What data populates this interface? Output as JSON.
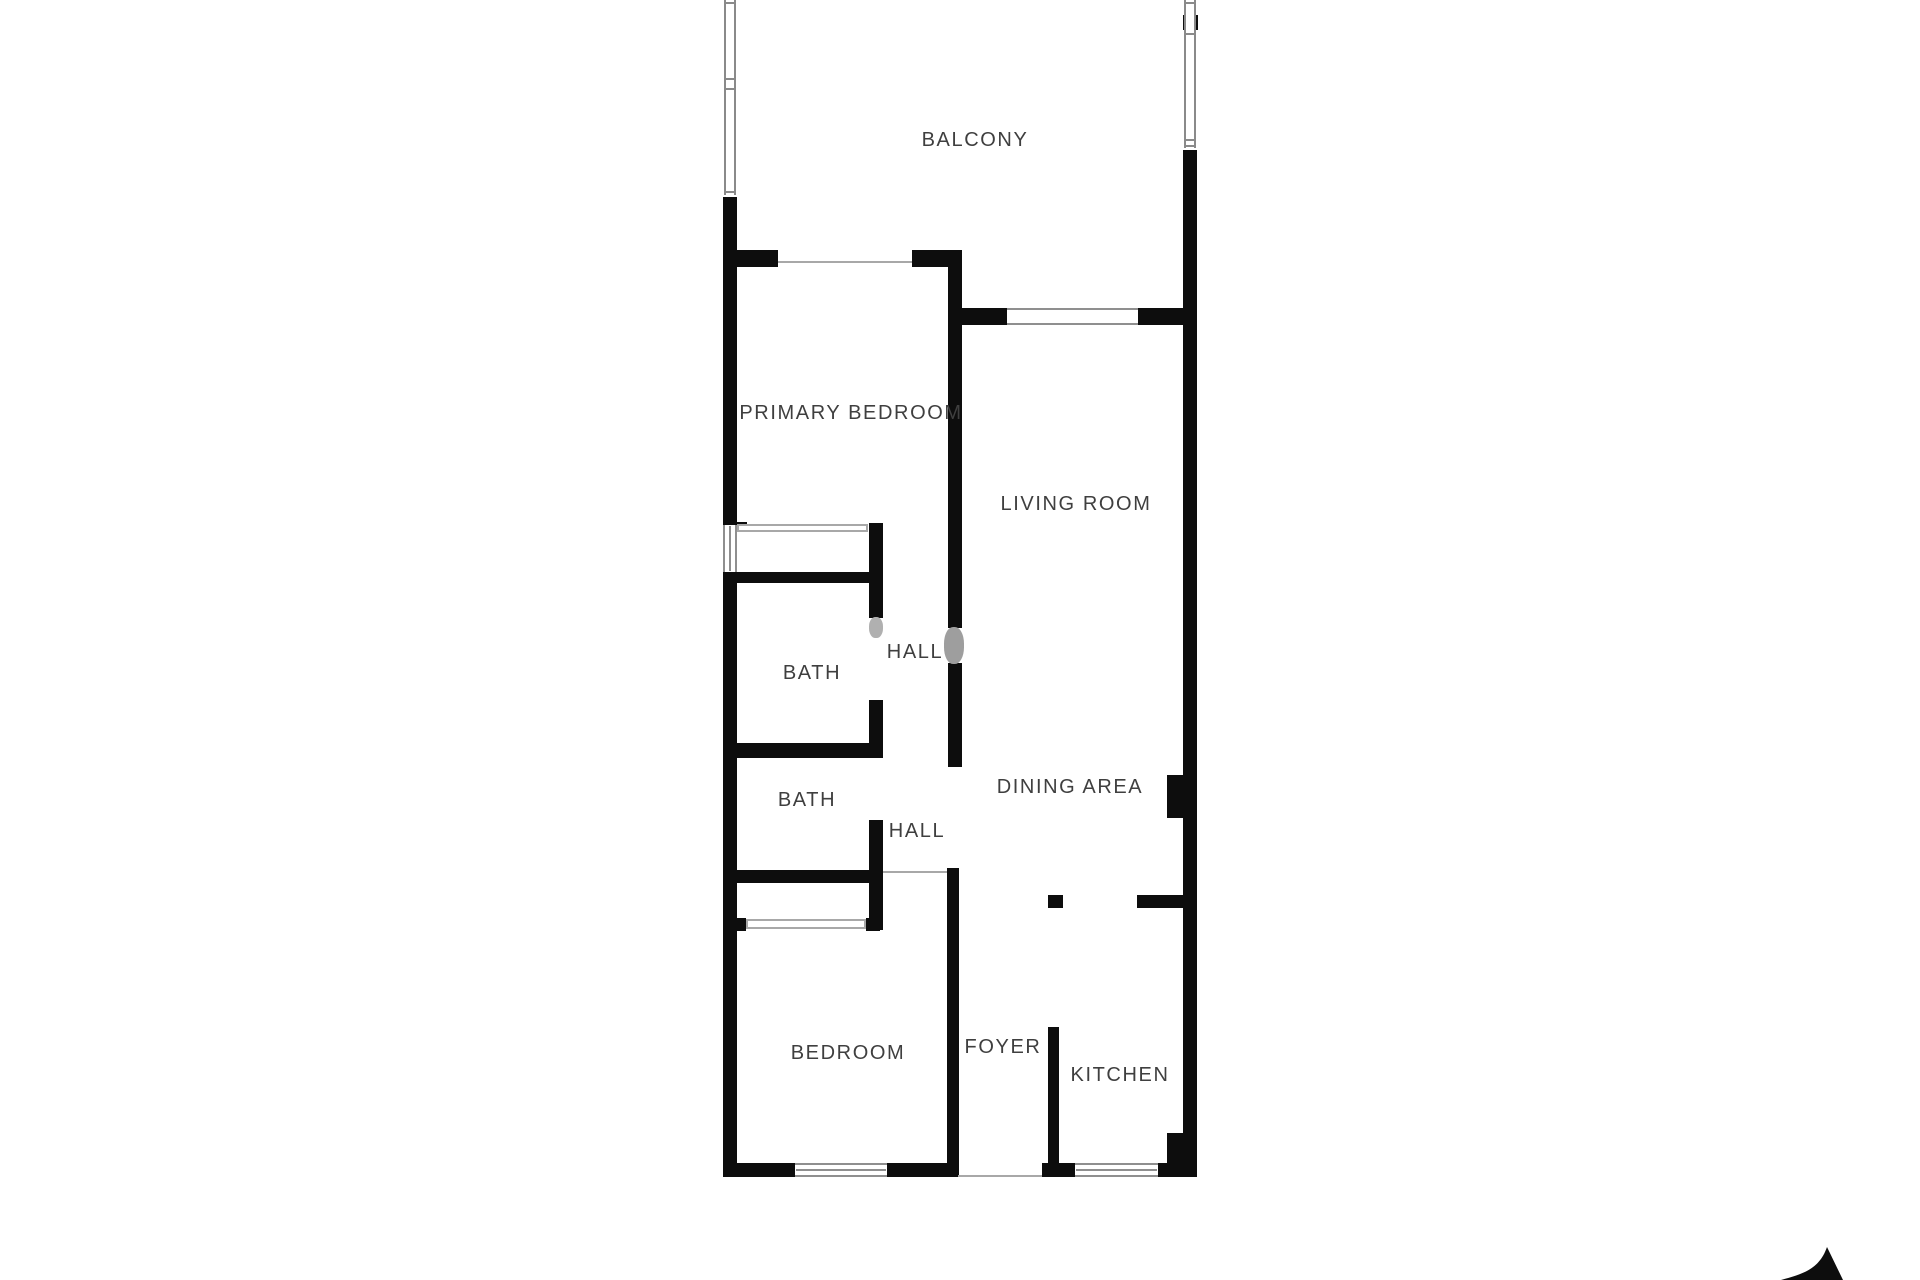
{
  "plan": {
    "colors": {
      "background": "#ffffff",
      "wall": "#0d0d0d",
      "thin_line": "#a8a8a8",
      "window_frame": "#8f8f8f",
      "label_text": "#3f3f3f",
      "watermark": "#9e9e9e"
    },
    "rooms": [
      {
        "id": "balcony",
        "label": "BALCONY",
        "x": 975,
        "y": 140
      },
      {
        "id": "primary-bedroom",
        "label": "PRIMARY BEDROOM",
        "x": 851,
        "y": 413
      },
      {
        "id": "living-room",
        "label": "LIVING ROOM",
        "x": 1076,
        "y": 504
      },
      {
        "id": "bath-1",
        "label": "BATH",
        "x": 812,
        "y": 673
      },
      {
        "id": "hall-1",
        "label": "HALL",
        "x": 915,
        "y": 652
      },
      {
        "id": "bath-2",
        "label": "BATH",
        "x": 807,
        "y": 800
      },
      {
        "id": "hall-2",
        "label": "HALL",
        "x": 917,
        "y": 831
      },
      {
        "id": "dining-area",
        "label": "DINING AREA",
        "x": 1070,
        "y": 787
      },
      {
        "id": "bedroom",
        "label": "BEDROOM",
        "x": 848,
        "y": 1053
      },
      {
        "id": "foyer",
        "label": "FOYER",
        "x": 1003,
        "y": 1047
      },
      {
        "id": "kitchen",
        "label": "KITCHEN",
        "x": 1120,
        "y": 1075
      }
    ],
    "walls": [
      {
        "name": "left-wall-upper",
        "x": 723,
        "y": 197,
        "w": 14,
        "h": 328
      },
      {
        "name": "left-wall-lower",
        "x": 723,
        "y": 572,
        "w": 14,
        "h": 605
      },
      {
        "name": "primary-bedroom-top-wall-left",
        "x": 723,
        "y": 250,
        "w": 55,
        "h": 17
      },
      {
        "name": "primary-bedroom-top-wall-right",
        "x": 912,
        "y": 250,
        "w": 50,
        "h": 17
      },
      {
        "name": "living-wall-upper",
        "x": 948,
        "y": 250,
        "w": 14,
        "h": 378
      },
      {
        "name": "living-wall-lower",
        "x": 948,
        "y": 663,
        "w": 14,
        "h": 104
      },
      {
        "name": "living-room-top-wall-left",
        "x": 948,
        "y": 308,
        "w": 59,
        "h": 17
      },
      {
        "name": "living-room-top-wall-right",
        "x": 1138,
        "y": 308,
        "w": 59,
        "h": 17
      },
      {
        "name": "right-wall-balcony-stub",
        "x": 1183,
        "y": 15,
        "w": 15,
        "h": 15
      },
      {
        "name": "right-wall",
        "x": 1183,
        "y": 150,
        "w": 14,
        "h": 1027
      },
      {
        "name": "dining-column",
        "x": 1167,
        "y": 775,
        "w": 16,
        "h": 43
      },
      {
        "name": "bath-top-wall",
        "x": 723,
        "y": 572,
        "w": 160,
        "h": 11
      },
      {
        "name": "bath-hall-wall-upper",
        "x": 869,
        "y": 523,
        "w": 14,
        "h": 95
      },
      {
        "name": "bath-hall-wall-mid",
        "x": 869,
        "y": 700,
        "w": 14,
        "h": 58
      },
      {
        "name": "bath-hall-wall-lower",
        "x": 869,
        "y": 820,
        "w": 14,
        "h": 110
      },
      {
        "name": "bath-divider-wall",
        "x": 723,
        "y": 743,
        "w": 160,
        "h": 15
      },
      {
        "name": "hall-bottom-wall",
        "x": 723,
        "y": 870,
        "w": 157,
        "h": 13
      },
      {
        "name": "closet-stub-top-left",
        "x": 735,
        "y": 522,
        "w": 12,
        "h": 10
      },
      {
        "name": "closet-stub-bottom-left",
        "x": 735,
        "y": 918,
        "w": 11,
        "h": 13
      },
      {
        "name": "closet-stub-bottom-right",
        "x": 866,
        "y": 918,
        "w": 14,
        "h": 13
      },
      {
        "name": "foyer-wall",
        "x": 947,
        "y": 868,
        "w": 12,
        "h": 309
      },
      {
        "name": "kitchen-left-wall",
        "x": 1048,
        "y": 1027,
        "w": 11,
        "h": 136
      },
      {
        "name": "kitchen-entry-column",
        "x": 1048,
        "y": 895,
        "w": 15,
        "h": 13
      },
      {
        "name": "kitchen-entry-stub",
        "x": 1137,
        "y": 895,
        "w": 46,
        "h": 13
      },
      {
        "name": "kitchen-corner-block",
        "x": 1167,
        "y": 1133,
        "w": 26,
        "h": 30
      },
      {
        "name": "bedroom-bottom-wall-left",
        "x": 723,
        "y": 1163,
        "w": 72,
        "h": 14
      },
      {
        "name": "bedroom-bottom-wall-right",
        "x": 887,
        "y": 1163,
        "w": 71,
        "h": 14
      },
      {
        "name": "kitchen-bottom-wall-left",
        "x": 1042,
        "y": 1163,
        "w": 33,
        "h": 14
      },
      {
        "name": "kitchen-bottom-wall-right",
        "x": 1158,
        "y": 1163,
        "w": 39,
        "h": 14
      }
    ],
    "windows": [
      {
        "name": "left-wall-window",
        "x": 723,
        "y": 525,
        "w": 14,
        "h": 47,
        "orient": "v",
        "mid": true
      },
      {
        "name": "living-room-window",
        "x": 1007,
        "y": 308,
        "w": 131,
        "h": 17,
        "orient": "h",
        "mid": false
      },
      {
        "name": "bedroom-window",
        "x": 795,
        "y": 1163,
        "w": 92,
        "h": 14,
        "orient": "h",
        "mid": true
      },
      {
        "name": "kitchen-window",
        "x": 1075,
        "y": 1163,
        "w": 83,
        "h": 14,
        "orient": "h",
        "mid": true
      }
    ],
    "railings": [
      {
        "name": "balcony-railing-left",
        "x": 724,
        "y": 0,
        "w": 12,
        "h": 195,
        "ticks": [
          2,
          78,
          88,
          191
        ]
      },
      {
        "name": "balcony-railing-right",
        "x": 1184,
        "y": 0,
        "w": 12,
        "h": 148,
        "ticks": [
          2,
          33,
          139,
          145
        ]
      }
    ],
    "thin_lines": [
      {
        "name": "balcony-door-sill",
        "x": 778,
        "y": 261,
        "w": 134,
        "h": 2
      },
      {
        "name": "hall-foyer-threshold",
        "x": 883,
        "y": 871,
        "w": 64,
        "h": 2
      },
      {
        "name": "entry-threshold",
        "x": 958,
        "y": 1175,
        "w": 84,
        "h": 2
      }
    ],
    "closet_fronts": [
      {
        "name": "primary-closet-front",
        "x": 737,
        "y": 524,
        "w": 131,
        "h": 8
      },
      {
        "name": "bedroom-closet-front",
        "x": 746,
        "y": 919,
        "w": 120,
        "h": 10
      }
    ],
    "smudges": [
      {
        "name": "watermark-smudge-1",
        "x": 944,
        "y": 627,
        "w": 20,
        "h": 37,
        "color": "#9e9e9e"
      },
      {
        "name": "watermark-smudge-2",
        "x": 869,
        "y": 617,
        "w": 14,
        "h": 21,
        "color": "#b0b0b0"
      }
    ],
    "compass": {
      "name": "north-arrow",
      "direction": "north"
    }
  }
}
